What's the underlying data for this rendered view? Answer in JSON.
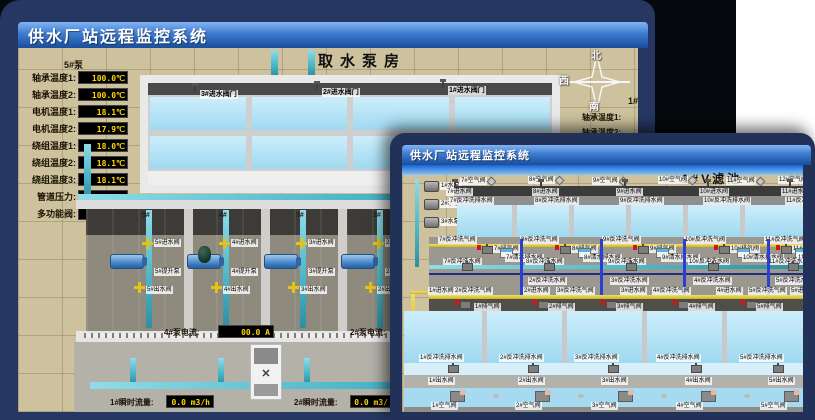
{
  "back": {
    "titlebar": "供水厂站远程监控系统",
    "scene": "取水泵房",
    "panel5": {
      "header": "5#泵",
      "rows": [
        {
          "l": "轴承温度1:",
          "v": "100.0℃"
        },
        {
          "l": "轴承温度2:",
          "v": "100.0℃"
        },
        {
          "l": "电机温度1:",
          "v": "18.1℃"
        },
        {
          "l": "电机温度2:",
          "v": "17.9℃"
        },
        {
          "l": "绕组温度1:",
          "v": "18.0℃"
        },
        {
          "l": "绕组温度2:",
          "v": "18.1℃"
        },
        {
          "l": "绕组温度3:",
          "v": "18.1℃"
        },
        {
          "l": "管道压力:",
          "v": "0.0007MPa"
        },
        {
          "l": "多功能阀:",
          "v": "0%"
        }
      ]
    },
    "intake": [
      "3#进水阀门",
      "2#进水阀门",
      "1#进水阀门"
    ],
    "compass": {
      "n": "北",
      "w": "西",
      "s": "南"
    },
    "panel1": {
      "header": "1#泵",
      "rows": [
        "轴承温度1:",
        "轴承温度2:"
      ]
    },
    "bays": [
      {
        "no": "5#",
        "in": "5#进水阀",
        "pump": "5#提升泵",
        "out": "5#出水阀"
      },
      {
        "no": "4#",
        "in": "4#进水阀",
        "pump": "4#提升泵",
        "out": "4#出水阀"
      },
      {
        "no": "3#",
        "in": "3#进水阀",
        "pump": "3#提升泵",
        "out": "3#出水阀"
      },
      {
        "no": "2#",
        "in": "2#进水阀",
        "pump": "2#提升泵",
        "out": "2#出水阀"
      }
    ],
    "current": [
      {
        "l": "4#泵电流:",
        "v": "00.0 A"
      },
      {
        "l": "2#泵电流:",
        "v": ""
      }
    ],
    "flow": [
      {
        "l": "1#瞬时流量:",
        "v": "0.0 m3/h"
      },
      {
        "l": "2#瞬时流量:",
        "v": "0.0 m3/"
      }
    ]
  },
  "front": {
    "titlebar": "供水厂站远程监控系统",
    "scene": "1#V滤池",
    "pumps": [
      "1#水泵",
      "2#水泵",
      "3#水泵"
    ],
    "air_top": [
      "7#空气阀",
      "8#空气阀",
      "9#空气阀",
      "10#空气阀",
      "11#空气阀",
      "12#空气阀"
    ],
    "inlet_top": [
      "7#进水阀",
      "8#进水阀",
      "9#进水阀",
      "10#进水阀",
      "11#进水阀"
    ],
    "drain_top": [
      "7#反冲洗排水阀",
      "8#反冲洗排水阀",
      "9#反冲洗排水阀",
      "10#反冲洗排水阀",
      "11#反冲洗排水阀"
    ],
    "scour": [
      "7#反冲洗气阀",
      "8#反冲洗气阀",
      "9#反冲洗气阀",
      "10#反冲洗气阀",
      "11#反冲洗气阀"
    ],
    "exhaust_top": [
      "7#排气阀",
      "8#排气阀",
      "9#排气阀",
      "10#排气阀",
      "11#排气阀"
    ],
    "clear": [
      "7#清水排水阀",
      "8#清水排水阀",
      "9#清水排水阀",
      "10#清水排水阀",
      "11#清水排水阀"
    ],
    "backwash": [
      "7#反冲洗水阀",
      "8#反冲洗水阀",
      "9#反冲洗水阀",
      "10#反冲洗水阀",
      "11#反冲洗水阀"
    ],
    "cross": [
      "2#反冲洗水阀",
      "3#反冲洗水阀",
      "4#反冲洗水阀",
      "5#反冲洗水阀"
    ],
    "pipe_row": [
      "1#进水阀",
      "2#反冲洗气阀",
      "2#进水阀",
      "3#反冲洗气阀",
      "3#进水阀",
      "4#反冲洗气阀",
      "4#进水阀",
      "5#反冲洗气阀",
      "5#进水阀"
    ],
    "exhaust_bot": [
      "1#排气阀",
      "2#排气阀",
      "3#排气阀",
      "4#排气阀",
      "5#排气阀"
    ],
    "drain_bot": [
      "1#反冲洗排水阀",
      "2#反冲洗排水阀",
      "3#反冲洗排水阀",
      "4#反冲洗排水阀",
      "5#反冲洗排水阀"
    ],
    "outlet": [
      "1#出水阀",
      "2#出水阀",
      "3#出水阀",
      "4#出水阀",
      "5#出水阀"
    ],
    "air_bot": [
      "1#空气阀",
      "2#空气阀",
      "3#空气阀",
      "4#空气阀",
      "5#空气阀"
    ]
  },
  "colors": {
    "titlebar_top": "#82b4f2",
    "titlebar_bottom": "#1b4d9b",
    "value_text": "#ffd800",
    "ground": "#cdc29d",
    "pipe_cyan": "#49b4c8",
    "pipe_yellow": "#e5c217",
    "pipe_blue": "#2b3fd4",
    "alarm_red": "#d31515"
  }
}
